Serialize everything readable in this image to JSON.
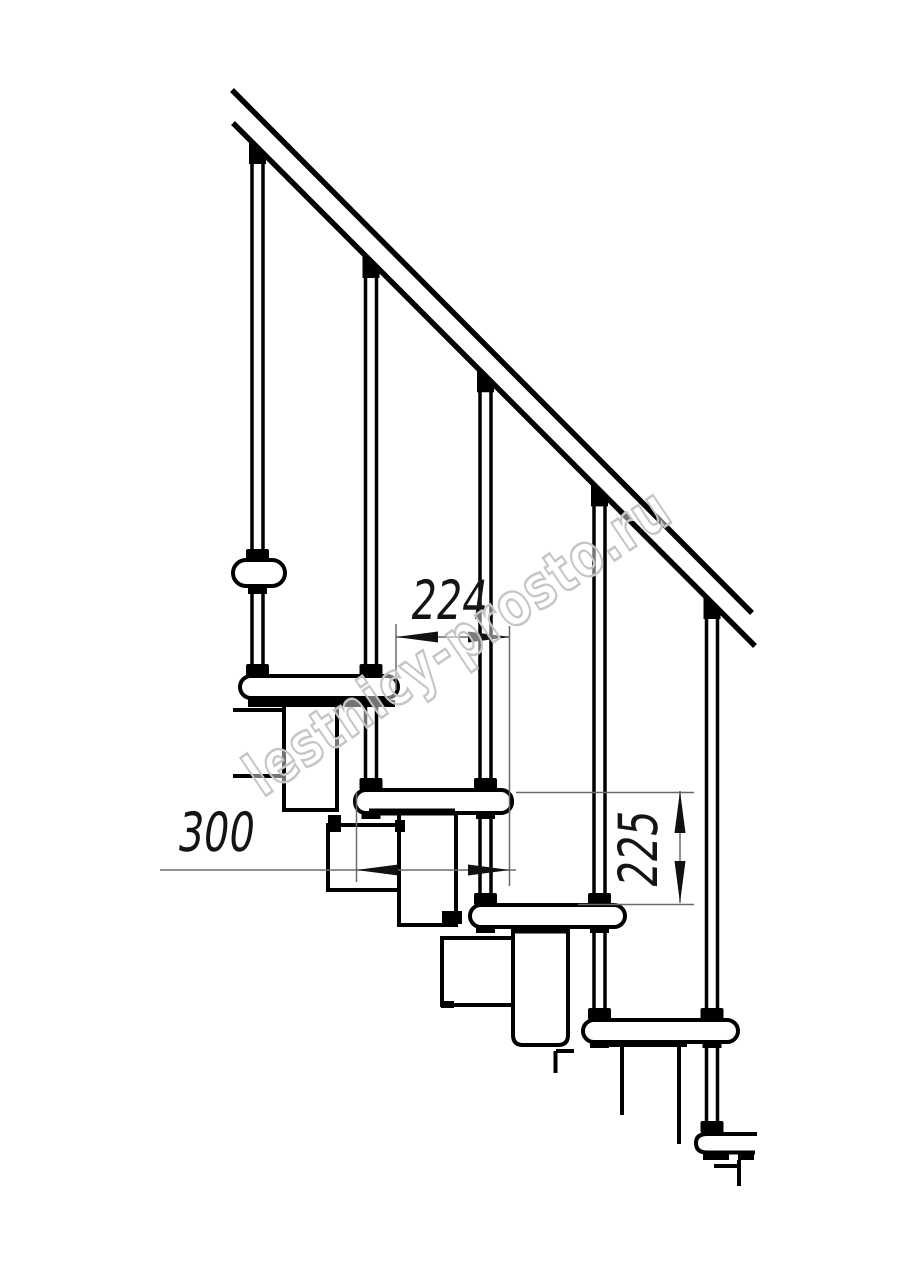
{
  "drawing": {
    "title": "modular staircase side elevation drawing",
    "watermark": {
      "text": "lestnicy-prosto.ru",
      "color": "#c5c5c5"
    },
    "dims": {
      "going": {
        "value": "224",
        "orientation": "horizontal"
      },
      "depth": {
        "value": "300",
        "orientation": "horizontal"
      },
      "riser": {
        "value": "225",
        "orientation": "vertical"
      }
    },
    "counts": {
      "balusters": 5,
      "treads": 5
    },
    "colors": {
      "line": "#000000",
      "dim_line": "#6a6a6a",
      "dim_text": "#141414",
      "background": "#ffffff"
    }
  }
}
